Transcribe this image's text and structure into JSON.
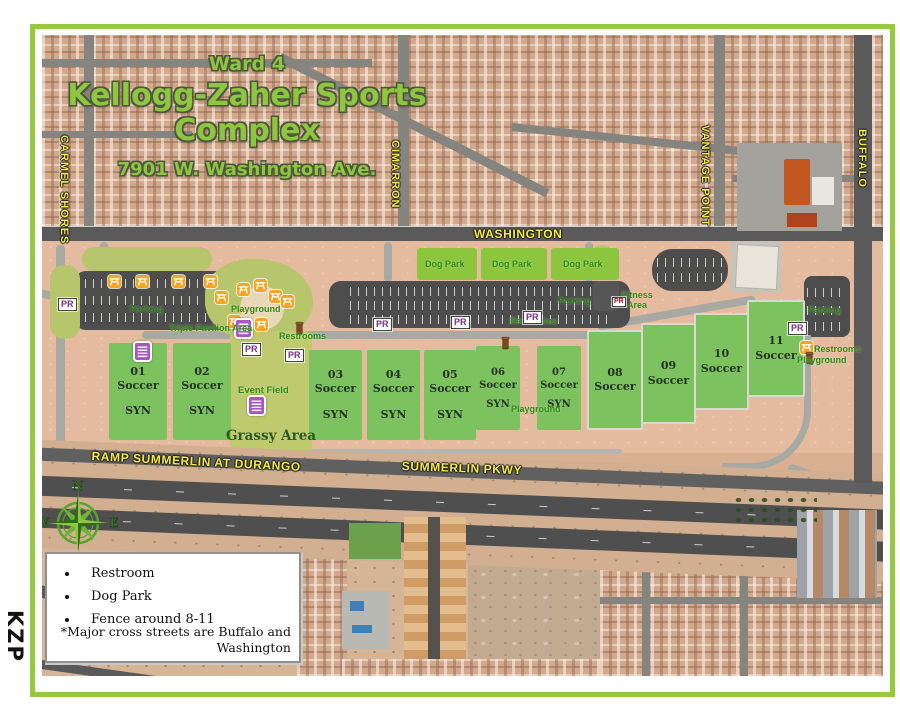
{
  "watermark": "KZP",
  "header": {
    "ward": "Ward 4",
    "title": "Kellogg-Zaher Sports Complex",
    "address": "7901 W. Washington Ave."
  },
  "streets": {
    "carmel_shores": "CARMEL SHORES",
    "cimarron": "CIMARRON",
    "washington": "WASHINGTON",
    "vantage_point": "VANTAGE POINT",
    "buffalo": "BUFFALO",
    "ramp_summerlin": "RAMP SUMMERLIN AT DURANGO",
    "summerlin_pkwy": "SUMMERLIN PKWY"
  },
  "labels": {
    "parking": "Parking",
    "restrooms": "Restrooms",
    "playground": "Playground",
    "dog_park": "Dog Park",
    "triple_pavilion": "Triple Pavilion Area",
    "fitness_area": "Fitness Area",
    "event_field": "Event Field",
    "grassy_area": "Grassy Area",
    "pr": "PR"
  },
  "fields": [
    {
      "num": "01",
      "name": "Soccer",
      "syn": "SYN"
    },
    {
      "num": "02",
      "name": "Soccer",
      "syn": "SYN"
    },
    {
      "num": "03",
      "name": "Soccer",
      "syn": "SYN"
    },
    {
      "num": "04",
      "name": "Soccer",
      "syn": "SYN"
    },
    {
      "num": "05",
      "name": "Soccer",
      "syn": "SYN"
    },
    {
      "num": "06",
      "name": "Soccer",
      "syn": "SYN"
    },
    {
      "num": "07",
      "name": "Soccer",
      "syn": "SYN"
    },
    {
      "num": "08",
      "name": "Soccer"
    },
    {
      "num": "09",
      "name": "Soccer"
    },
    {
      "num": "10",
      "name": "Soccer"
    },
    {
      "num": "11",
      "name": "Soccer"
    }
  ],
  "legend": {
    "items": [
      "Restroom",
      "Dog Park",
      "Fence around 8-11"
    ],
    "note": "*Major cross streets are Buffalo and Washington"
  },
  "compass": {
    "n": "N",
    "e": "E",
    "s": "S",
    "w": "W"
  },
  "colors": {
    "frame_green": "#96c93d",
    "title_green": "#8dc63f",
    "street_yellow": "#f7ec3e",
    "field_green": "#7cc25e",
    "dogpark_green": "#8cc63f",
    "label_green": "#2e8b12",
    "pr_purple": "#7b2d8b",
    "picnic_orange": "#f5a423",
    "restroom_purple": "#a855c7"
  }
}
